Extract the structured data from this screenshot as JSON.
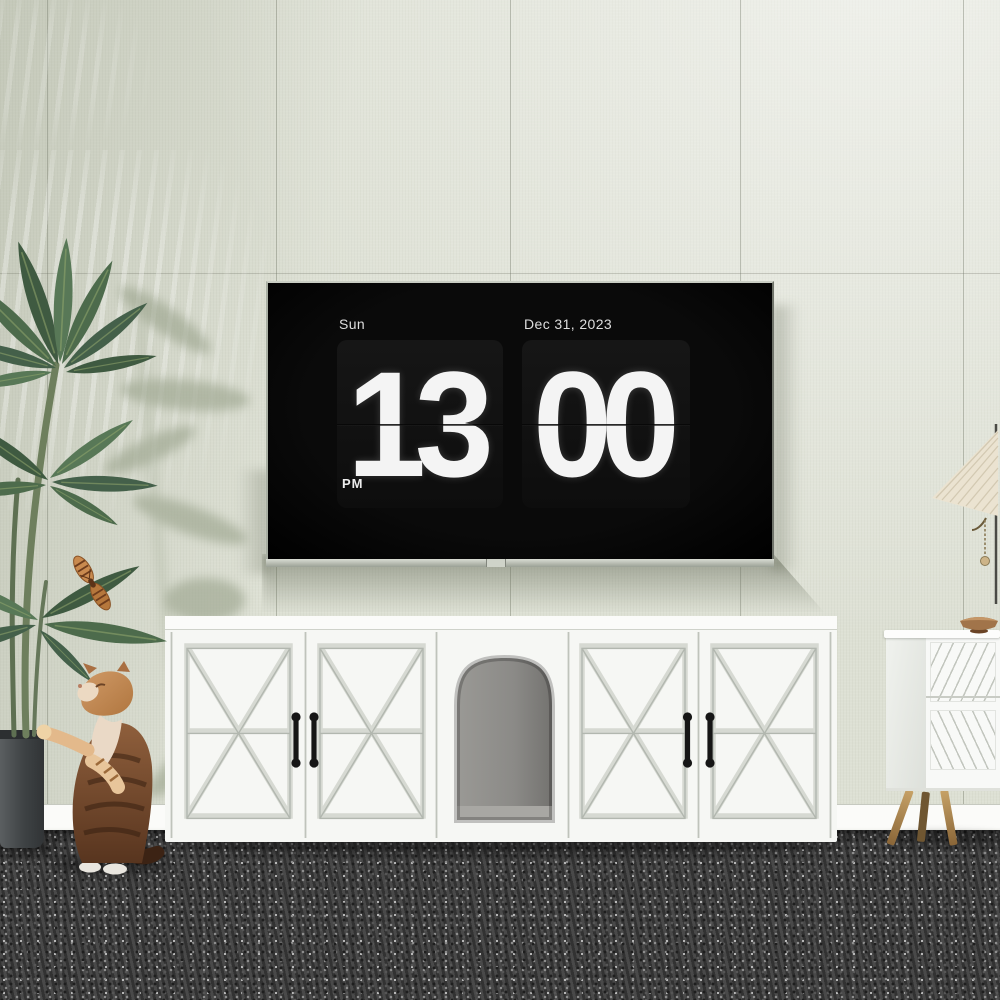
{
  "clock": {
    "day": "Sun",
    "date": "Dec 31, 2023",
    "hour": "13",
    "minute": "00",
    "meridiem": "PM"
  },
  "colors": {
    "wall": "#dde0d4",
    "carpet": "#3f3f3f",
    "tv_screen": "#050505",
    "clock_card": "#161616",
    "clock_text": "#f4f4f4",
    "furniture_white": "#f6f7f4",
    "handle_black": "#1a1a1a",
    "brass_leg": "#b28c52",
    "leaf_green": "#4d6b4c",
    "cat_brown": "#7d4f33",
    "lamp_shade": "#ebe3d1",
    "bowl_wood": "#a1744a",
    "pot_gray": "#46494b"
  }
}
